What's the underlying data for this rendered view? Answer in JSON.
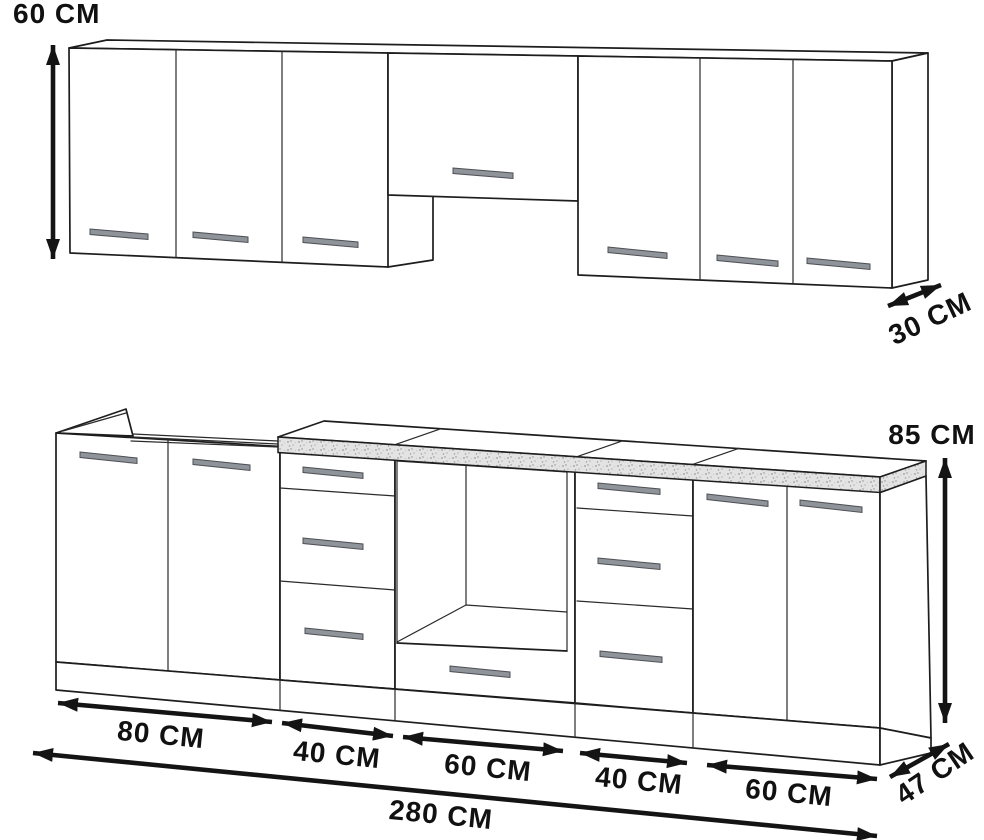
{
  "labels": {
    "wall_height": "60 CM",
    "wall_depth": "30 CM",
    "base_height": "85 CM",
    "base_depth": "47 CM",
    "total_width": "280 CM",
    "widths": [
      "80 CM",
      "40 CM",
      "60 CM",
      "40 CM",
      "60 CM"
    ]
  },
  "colors": {
    "line": "#1d1d1d",
    "dimension_line": "#141414",
    "label_text": "#111111",
    "handle_fill": "#8f939a",
    "handle_stroke": "#4d5054",
    "countertop_fill": "#e3e3e3",
    "countertop_speckle": "#9b9b9b",
    "background": "#ffffff"
  }
}
